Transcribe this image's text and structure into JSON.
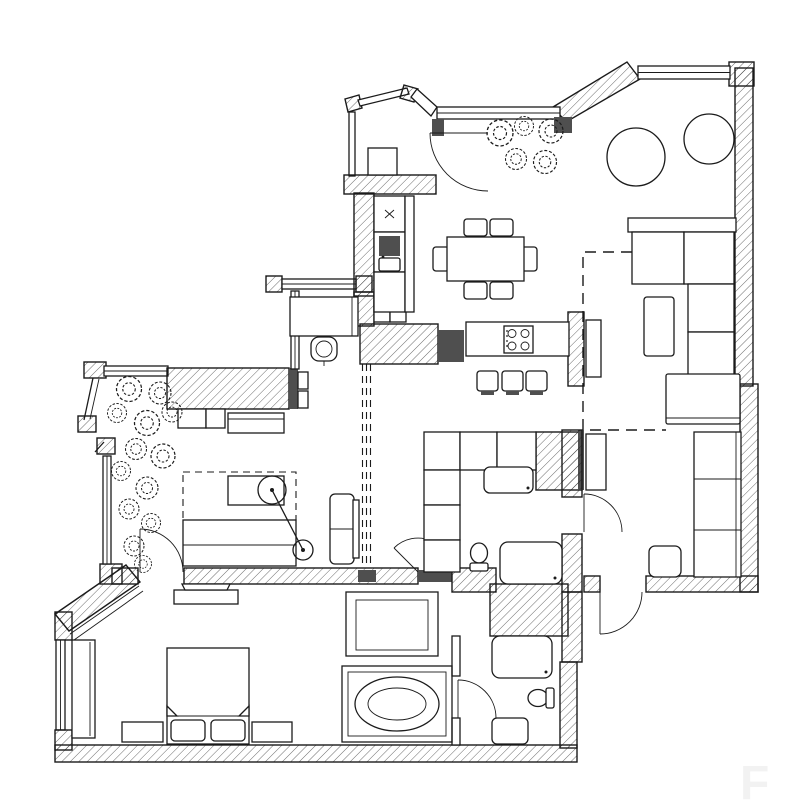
{
  "meta": {
    "kind": "architectural-floor-plan",
    "view": "top-down",
    "style": "monochrome line drawing with diagonal-hatched walls, door swing arcs and furniture symbols"
  },
  "colors": {
    "paper": "#ffffff",
    "ink": "#1b1b1b",
    "dark": "#4f4f4f",
    "mid": "#7b7b7b",
    "faint": "#f2f2f2"
  },
  "watermark": {
    "text": "F"
  },
  "rooms": [
    {
      "id": "entry-terrace",
      "items": [
        "angled glazed bay",
        "cabinet",
        "door swing",
        "potted plants"
      ]
    },
    {
      "id": "kitchen-dining",
      "items": [
        "tall cabinet with x mark",
        "sink with drainer",
        "base cabinets",
        "island counter with 4-burner hob",
        "3 bar stools",
        "dining table",
        "6 chairs"
      ]
    },
    {
      "id": "living-room",
      "items": [
        "L-shaped sectional sofa",
        "chaise",
        "coffee table",
        "2 round tables",
        "console",
        "dashed zone boundary"
      ]
    },
    {
      "id": "study-nook",
      "items": [
        "desk",
        "task chair",
        "window"
      ]
    },
    {
      "id": "bedroom-2",
      "items": [
        "hatched wardrobe block",
        "dresser",
        "stools",
        "sofa-bed with dashed fold-out projection",
        "swivel table with pivot arm",
        "armchair",
        "sliding partition dashed tracks",
        "glazed bay with plants"
      ]
    },
    {
      "id": "master-bedroom",
      "items": [
        "double bed with 2 pillows",
        "2 bedside benches",
        "wardrobe",
        "tv console",
        "window",
        "door swing"
      ]
    },
    {
      "id": "bathroom",
      "items": [
        "shower enclosure",
        "rectangular bathtub with oval basin",
        "door swing"
      ]
    },
    {
      "id": "wc-1",
      "items": [
        "washbasin",
        "toilet",
        "washing machine",
        "storage cubbies",
        "door swing"
      ]
    },
    {
      "id": "wc-2",
      "items": [
        "washbasin",
        "toilet",
        "shower tray",
        "door swing"
      ]
    },
    {
      "id": "hall",
      "items": [
        "corridor",
        "apartment entrance door swing"
      ]
    }
  ]
}
